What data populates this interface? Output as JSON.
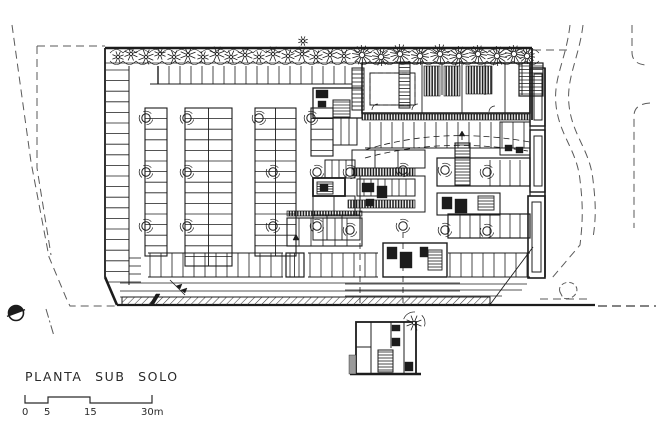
{
  "plan": {
    "title": "PLANTA SUB SOLO",
    "scale_bar": {
      "labels": [
        "0",
        "5",
        "15",
        "30m"
      ],
      "unit": "m"
    },
    "colors": {
      "ink": "#1c1c1c",
      "boundary": "#5a5a5a",
      "paper": "#ffffff"
    },
    "icons": {
      "north": "north-arrow-icon",
      "tree": "tree-icon",
      "column": "column-icon",
      "stair": "stair-icon"
    }
  }
}
